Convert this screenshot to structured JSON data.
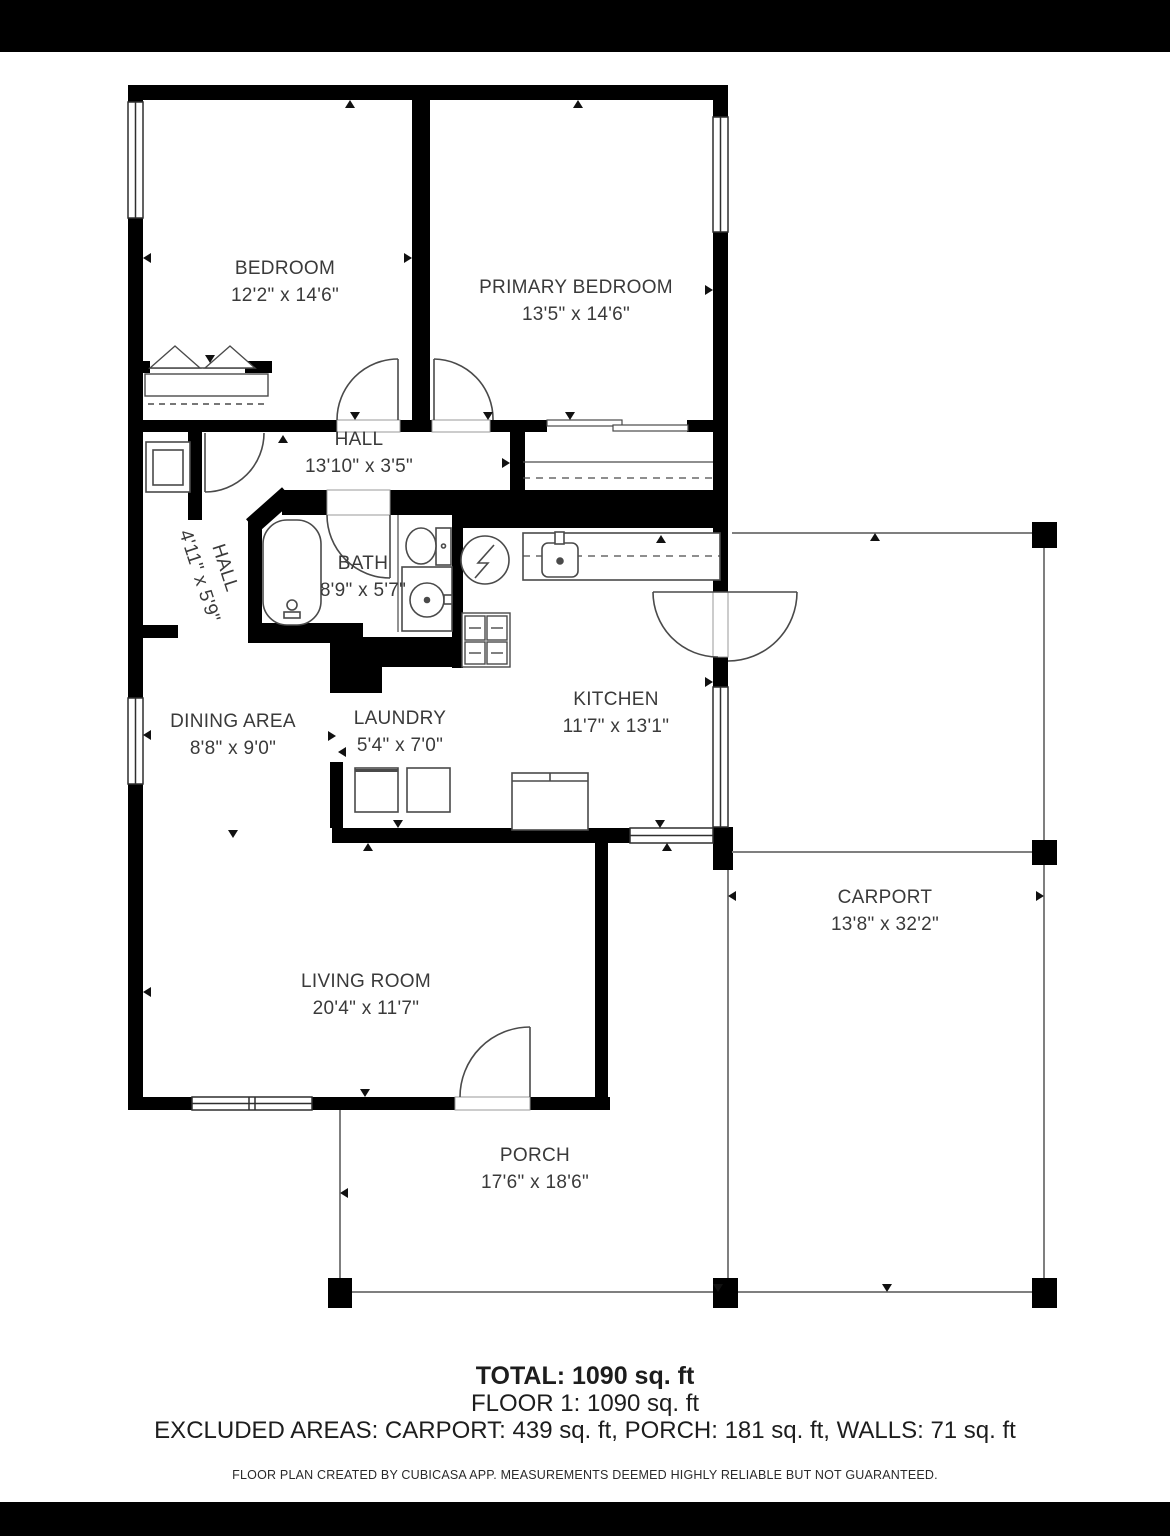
{
  "colors": {
    "walls": "#000000",
    "background": "#ffffff",
    "room_text": "#3a3a3a",
    "fixture_lines": "#4a4a4a",
    "outdoor_lines": "#7f7f7f"
  },
  "rooms": {
    "bedroom": {
      "label": "BEDROOM",
      "dims": "12'2\" x 14'6\""
    },
    "primary_bedroom": {
      "label": "PRIMARY BEDROOM",
      "dims": "13'5\" x 14'6\""
    },
    "hall": {
      "label": "HALL",
      "dims": "13'10\" x 3'5\""
    },
    "hall_entry": {
      "label": "HALL",
      "dims": "4'11\" x 5'9\""
    },
    "bath": {
      "label": "BATH",
      "dims": "8'9\" x 5'7\""
    },
    "kitchen": {
      "label": "KITCHEN",
      "dims": "11'7\" x 13'1\""
    },
    "dining_area": {
      "label": "DINING AREA",
      "dims": "8'8\" x 9'0\""
    },
    "laundry": {
      "label": "LAUNDRY",
      "dims": "5'4\" x 7'0\""
    },
    "living_room": {
      "label": "LIVING ROOM",
      "dims": "20'4\" x 11'7\""
    },
    "carport": {
      "label": "CARPORT",
      "dims": "13'8\" x 32'2\""
    },
    "porch": {
      "label": "PORCH",
      "dims": "17'6\" x 18'6\""
    }
  },
  "summary": {
    "total": "TOTAL: 1090 sq. ft",
    "floor": "FLOOR 1: 1090 sq. ft",
    "excluded": "EXCLUDED AREAS: CARPORT: 439 sq. ft, PORCH: 181 sq. ft, WALLS: 71 sq. ft",
    "disclaimer": "FLOOR PLAN CREATED BY CUBICASA APP. MEASUREMENTS DEEMED HIGHLY RELIABLE BUT NOT GUARANTEED."
  }
}
